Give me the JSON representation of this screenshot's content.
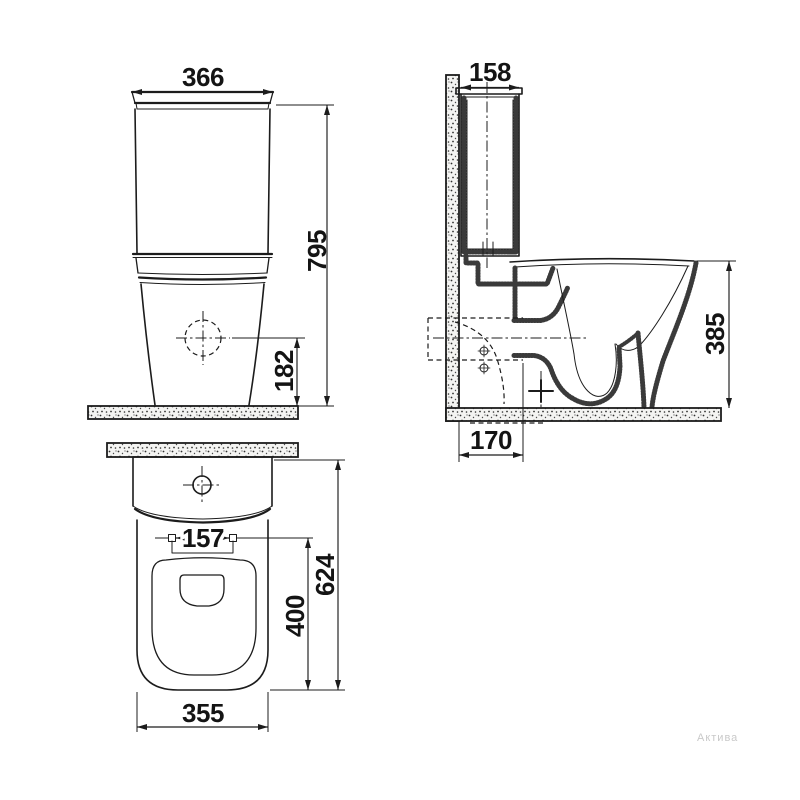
{
  "drawing": {
    "watermark": "Актива",
    "front_view": {
      "tank_width_mm": "366",
      "total_height_mm": "795",
      "drain_center_height_mm": "182"
    },
    "side_view": {
      "tank_depth_mm": "158",
      "bowl_height_mm": "385",
      "outlet_wall_distance_mm": "170"
    },
    "top_view": {
      "seat_hole_spacing_mm": "157",
      "total_depth_mm": "624",
      "seat_opening_length_mm": "400",
      "bowl_front_width_mm": "355"
    },
    "colors": {
      "ink": "#1c1c1c",
      "stipple": "#3a3a3a",
      "watermark": "#c9c9c9"
    }
  }
}
